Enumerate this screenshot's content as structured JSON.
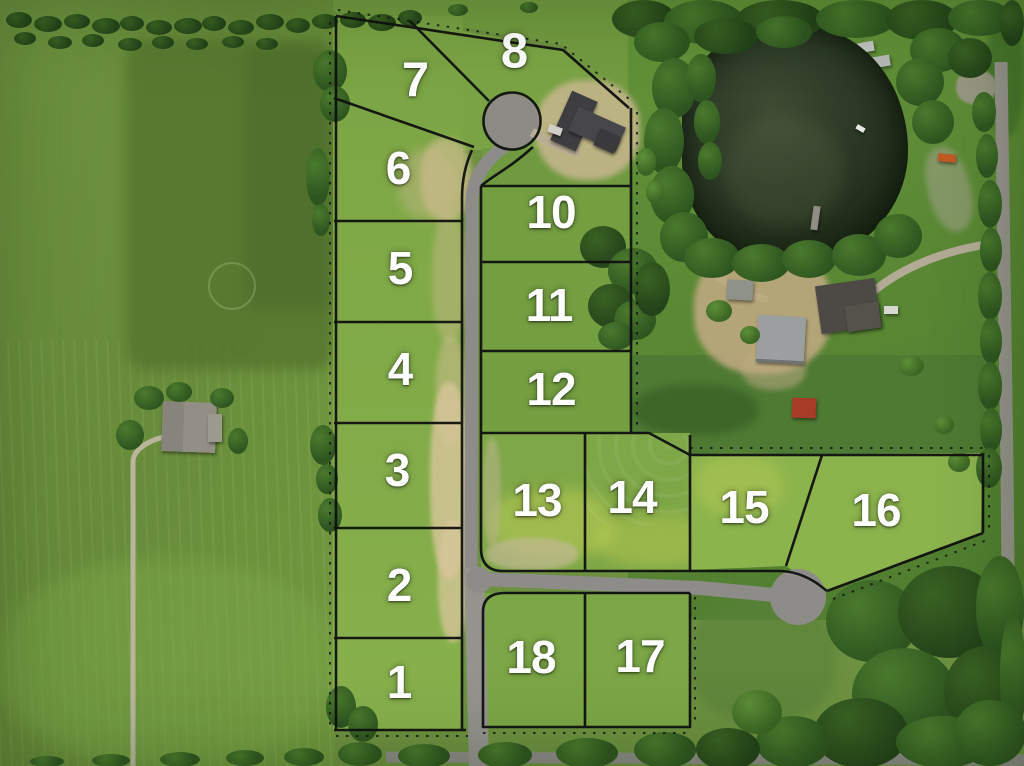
{
  "scene": {
    "description_label": "",
    "palette": {
      "plat_line": "#101010",
      "lot_label_text": "#ffffff",
      "road_asphalt": "#8d8c88",
      "pond_water": "#26321e",
      "field_green": "#6f9440",
      "bare_dirt": "#d0bd92"
    }
  },
  "lots": [
    {
      "label": "1"
    },
    {
      "label": "2"
    },
    {
      "label": "3"
    },
    {
      "label": "4"
    },
    {
      "label": "5"
    },
    {
      "label": "6"
    },
    {
      "label": "7"
    },
    {
      "label": "8"
    },
    {
      "label": "10"
    },
    {
      "label": "11"
    },
    {
      "label": "12"
    },
    {
      "label": "13"
    },
    {
      "label": "14"
    },
    {
      "label": "15"
    },
    {
      "label": "16"
    },
    {
      "label": "17"
    },
    {
      "label": "18"
    }
  ]
}
